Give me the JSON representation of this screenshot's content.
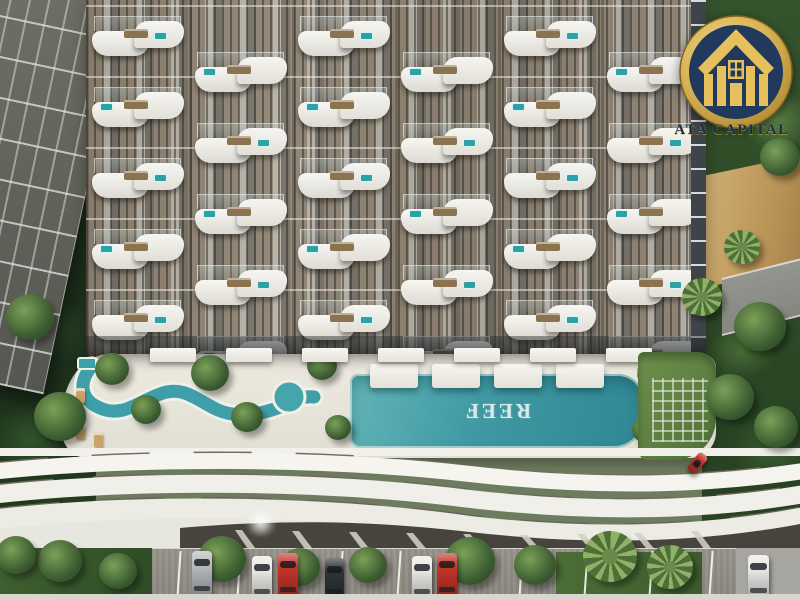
{
  "scene": {
    "description": "Aerial architectural rendering of a high-rise residential tower with staggered wavy white balconies, a rooftop amenity deck with lazy river and long infinity pool, a curved white parking podium and ground-level parking surrounded by tropical trees"
  },
  "logo": {
    "brand": "ATA CAPITAL",
    "icon": "house-columns-badge-icon",
    "gold": "#D8B45A",
    "navy": "#1E3A5C"
  },
  "pool": {
    "label": "REEF",
    "orientation": "rotated-180",
    "water_color": "#4AA4AA"
  },
  "palette": {
    "facade_light": "#A8A296",
    "facade_dark": "#555047",
    "balcony_white": "#F4F3EE",
    "deck_white": "#EAE7DD",
    "podium_white": "#F2F1EC",
    "foliage_dark": "#2E4A2B",
    "foliage_light": "#6F9A52",
    "sand": "#C9A96B",
    "asphalt": "#98958D",
    "car_red": "#C5352A",
    "car_silver": "#B7BABC",
    "car_white": "#EAE9E6",
    "car_dark": "#2F3438"
  },
  "building": {
    "grid": {
      "columns": 6,
      "rows": 5,
      "origin_x": 6,
      "origin_y": 16,
      "col_pitch": 103,
      "row_pitch": 71,
      "stagger": 36
    }
  },
  "deck": {
    "platforms_x": [
      370,
      432,
      494,
      556
    ],
    "cabanas_x": [
      150,
      226,
      302,
      378,
      454,
      530,
      606
    ],
    "loungers": [
      {
        "x": 76,
        "y": 388
      },
      {
        "x": 76,
        "y": 406
      },
      {
        "x": 76,
        "y": 424
      },
      {
        "x": 94,
        "y": 432
      },
      {
        "x": 60,
        "y": 398
      }
    ],
    "trees": [
      {
        "x": 112,
        "y": 370,
        "r": 17
      },
      {
        "x": 146,
        "y": 410,
        "r": 15
      },
      {
        "x": 210,
        "y": 374,
        "r": 19
      },
      {
        "x": 247,
        "y": 418,
        "r": 16
      },
      {
        "x": 322,
        "y": 366,
        "r": 15
      },
      {
        "x": 338,
        "y": 428,
        "r": 13
      },
      {
        "x": 655,
        "y": 374,
        "r": 18,
        "palm": true
      },
      {
        "x": 686,
        "y": 408,
        "r": 16,
        "palm": true
      },
      {
        "x": 646,
        "y": 430,
        "r": 14
      }
    ]
  },
  "parking": {
    "stall_lines_x": [
      178,
      238,
      292,
      340,
      398,
      455,
      520,
      585,
      650,
      710
    ],
    "cars": [
      {
        "x": 192,
        "y": 551,
        "w": 20,
        "h": 46,
        "color": "car_silver"
      },
      {
        "x": 252,
        "y": 556,
        "w": 20,
        "h": 44,
        "color": "car_white"
      },
      {
        "x": 278,
        "y": 553,
        "w": 20,
        "h": 45,
        "color": "car_red"
      },
      {
        "x": 325,
        "y": 558,
        "w": 19,
        "h": 42,
        "color": "car_dark"
      },
      {
        "x": 412,
        "y": 556,
        "w": 20,
        "h": 44,
        "color": "car_white"
      },
      {
        "x": 437,
        "y": 553,
        "w": 20,
        "h": 45,
        "color": "car_red"
      },
      {
        "x": 748,
        "y": 555,
        "w": 21,
        "h": 44,
        "color": "car_white"
      },
      {
        "x": 692,
        "y": 452,
        "w": 11,
        "h": 22,
        "color": "car_red",
        "rot": 40
      }
    ],
    "trees": [
      {
        "x": 222,
        "y": 560,
        "r": 24
      },
      {
        "x": 300,
        "y": 568,
        "r": 20
      },
      {
        "x": 368,
        "y": 566,
        "r": 19
      },
      {
        "x": 470,
        "y": 562,
        "r": 25
      },
      {
        "x": 535,
        "y": 566,
        "r": 21
      },
      {
        "x": 610,
        "y": 558,
        "r": 27,
        "palm": true
      },
      {
        "x": 670,
        "y": 568,
        "r": 23,
        "palm": true
      },
      {
        "x": 60,
        "y": 562,
        "r": 22
      },
      {
        "x": 118,
        "y": 572,
        "r": 19
      },
      {
        "x": 16,
        "y": 556,
        "r": 20
      }
    ]
  },
  "landscape": {
    "back_trees": [
      {
        "x": 20,
        "y": 56,
        "r": 22
      },
      {
        "x": 88,
        "y": 156,
        "r": 26,
        "palm": true
      },
      {
        "x": 40,
        "y": 208,
        "r": 22
      },
      {
        "x": 754,
        "y": 86,
        "r": 24
      },
      {
        "x": 780,
        "y": 158,
        "r": 20
      },
      {
        "x": 742,
        "y": 248,
        "r": 18,
        "palm": true
      }
    ],
    "front_trees": [
      {
        "x": 760,
        "y": 328,
        "r": 26
      },
      {
        "x": 702,
        "y": 298,
        "r": 20,
        "palm": true
      },
      {
        "x": 730,
        "y": 398,
        "r": 24
      },
      {
        "x": 776,
        "y": 428,
        "r": 22
      },
      {
        "x": 30,
        "y": 318,
        "r": 24
      },
      {
        "x": 60,
        "y": 418,
        "r": 26
      }
    ]
  }
}
